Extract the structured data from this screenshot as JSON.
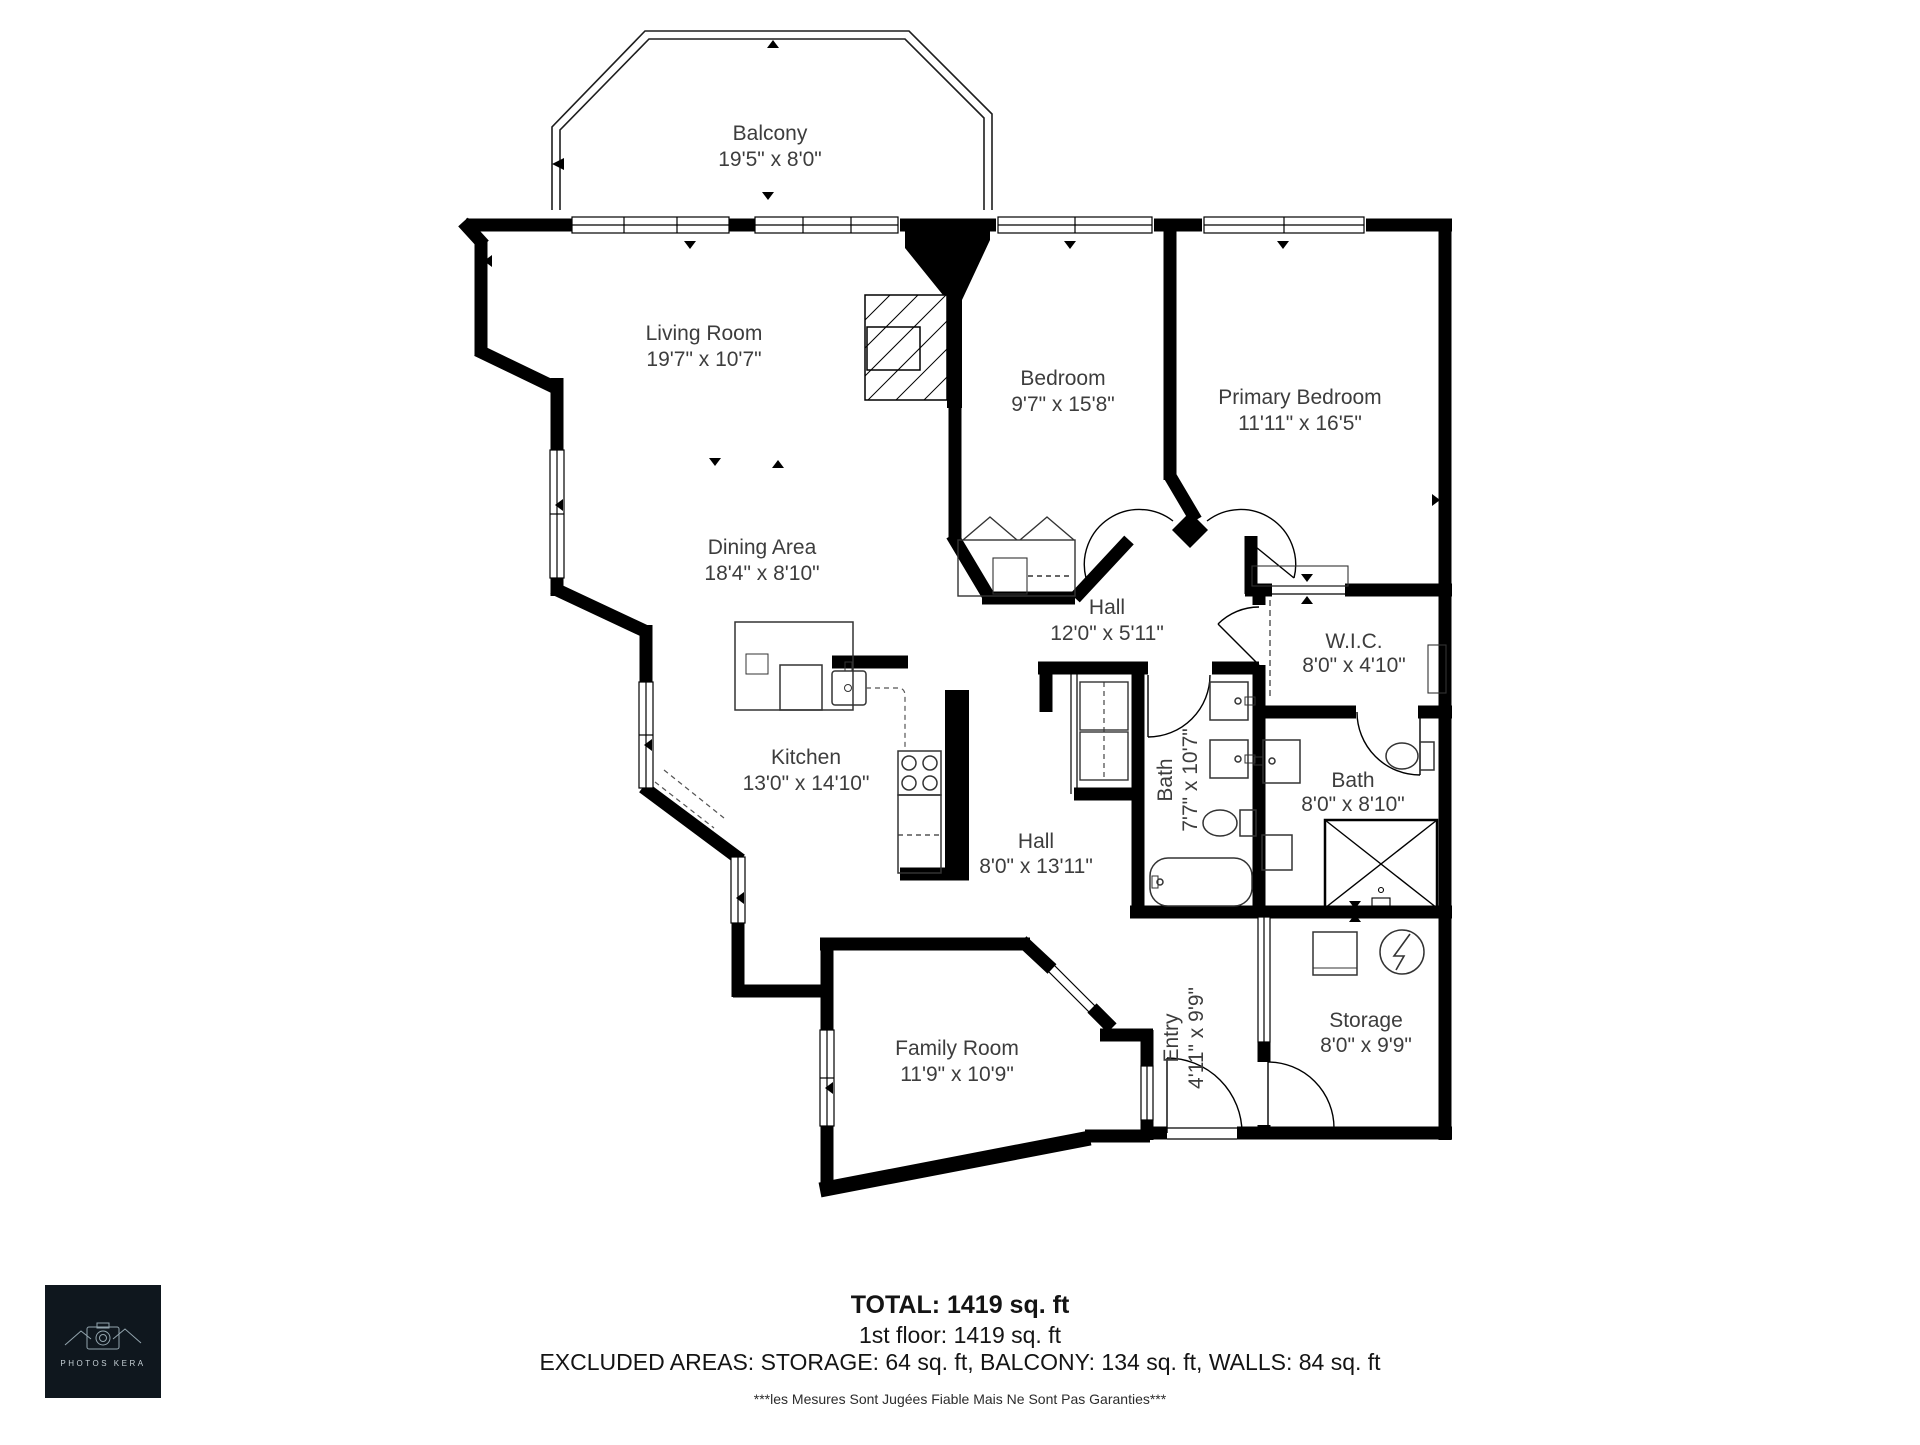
{
  "plan": {
    "rooms": [
      {
        "id": "balcony",
        "name": "Balcony",
        "dims": "19'5\" x 8'0\""
      },
      {
        "id": "living-room",
        "name": "Living Room",
        "dims": "19'7\" x 10'7\""
      },
      {
        "id": "bedroom",
        "name": "Bedroom",
        "dims": "9'7\" x 15'8\""
      },
      {
        "id": "primary-bedroom",
        "name": "Primary Bedroom",
        "dims": "11'11\" x 16'5\""
      },
      {
        "id": "dining-area",
        "name": "Dining Area",
        "dims": "18'4\" x 8'10\""
      },
      {
        "id": "hall-upper",
        "name": "Hall",
        "dims": "12'0\" x 5'11\""
      },
      {
        "id": "wic",
        "name": "W.I.C.",
        "dims": "8'0\" x 4'10\""
      },
      {
        "id": "kitchen",
        "name": "Kitchen",
        "dims": "13'0\" x 14'10\""
      },
      {
        "id": "bath-main",
        "name": "Bath",
        "dims": "7'7\" x 10'7\""
      },
      {
        "id": "bath-ensuite",
        "name": "Bath",
        "dims": "8'0\" x 8'10\""
      },
      {
        "id": "hall-lower",
        "name": "Hall",
        "dims": "8'0\" x 13'11\""
      },
      {
        "id": "family-room",
        "name": "Family Room",
        "dims": "11'9\" x 10'9\""
      },
      {
        "id": "entry",
        "name": "Entry",
        "dims": "4'11\" x 9'9\""
      },
      {
        "id": "storage",
        "name": "Storage",
        "dims": "8'0\" x 9'9\""
      }
    ],
    "summary": {
      "total": "TOTAL: 1419 sq. ft",
      "total_sqft": 1419,
      "first_floor": "1st floor: 1419 sq. ft",
      "first_floor_sqft": 1419,
      "excluded": "EXCLUDED AREAS: STORAGE: 64 sq. ft, BALCONY: 134 sq. ft, WALLS: 84 sq. ft",
      "excluded_areas": {
        "storage_sqft": 64,
        "balcony_sqft": 134,
        "walls_sqft": 84
      },
      "disclaimer": "***les Mesures Sont Jugées Fiable Mais Ne Sont Pas Garanties***"
    },
    "logo": {
      "text": "PHOTOS KERA"
    },
    "colors": {
      "walls": "#000000",
      "labels": "#3d3d3d",
      "logo_bg": "#0f171e"
    }
  }
}
